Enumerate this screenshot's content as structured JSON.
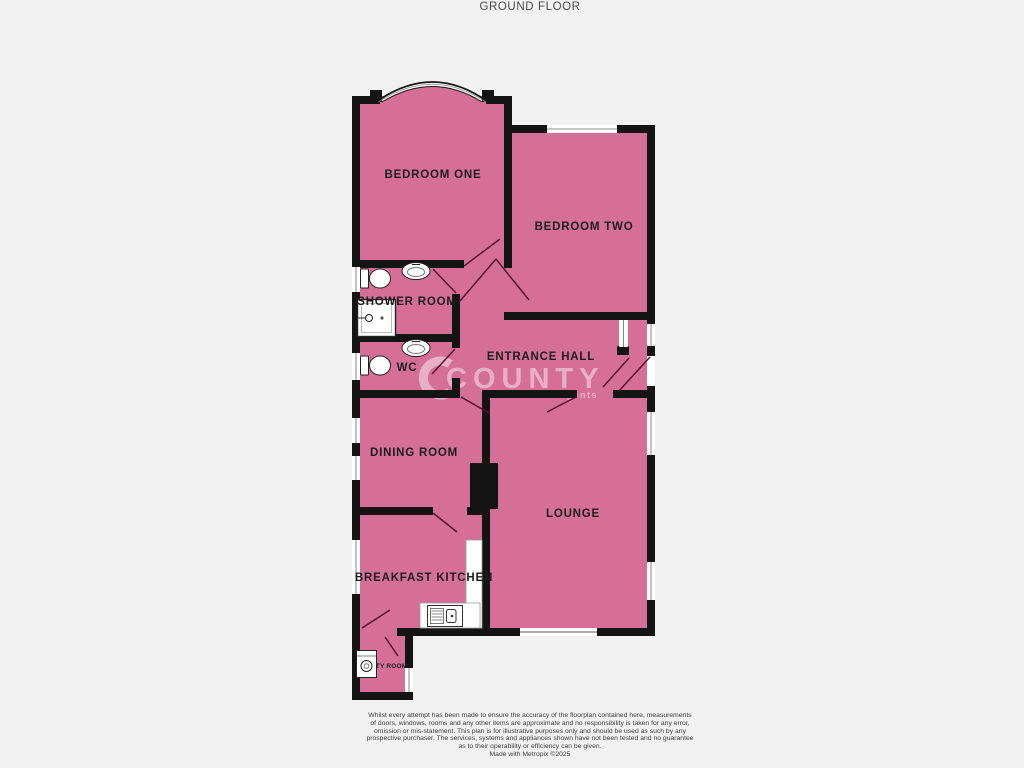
{
  "title": "GROUND FLOOR",
  "colors": {
    "room_fill": "#d56f96",
    "wall": "#141414",
    "label": "#1d1d1d",
    "background": "#f1f1f1",
    "door_swing": "#55122e",
    "window_fill": "#ffffff"
  },
  "rooms": {
    "bedroom_one": {
      "label": "BEDROOM ONE"
    },
    "bedroom_two": {
      "label": "BEDROOM TWO"
    },
    "shower_room": {
      "label": "SHOWER ROOM"
    },
    "wc": {
      "label": "WC"
    },
    "entrance_hall": {
      "label": "ENTRANCE HALL"
    },
    "dining_room": {
      "label": "DINING ROOM"
    },
    "lounge": {
      "label": "LOUNGE"
    },
    "breakfast_kitchen": {
      "label": "BREAKFAST KITCHEN"
    },
    "utility_room": {
      "label": "UTILITY ROOM"
    }
  },
  "fixtures": [
    "toilet",
    "wash-basin",
    "shower-tray",
    "worktop",
    "sink-drainer-unit",
    "washing-machine",
    "bay-window",
    "patio-door"
  ],
  "watermark": {
    "text": "COUNTY",
    "subtext": "estate agents"
  },
  "footer": {
    "disclaimer_lines": [
      "Whilst every attempt has been made to ensure the accuracy of the floorplan contained here, measurements",
      "of doors, windows, rooms and any other items are approximate and no responsibility is taken for any error,",
      "omission or mis-statement. This plan is for illustrative purposes only and should be used as such by any",
      "prospective purchaser. The services, systems and appliances shown have not been tested and no guarantee",
      "as to their operability or efficiency can be given."
    ],
    "credit": "Made with Metropix ©2025"
  }
}
